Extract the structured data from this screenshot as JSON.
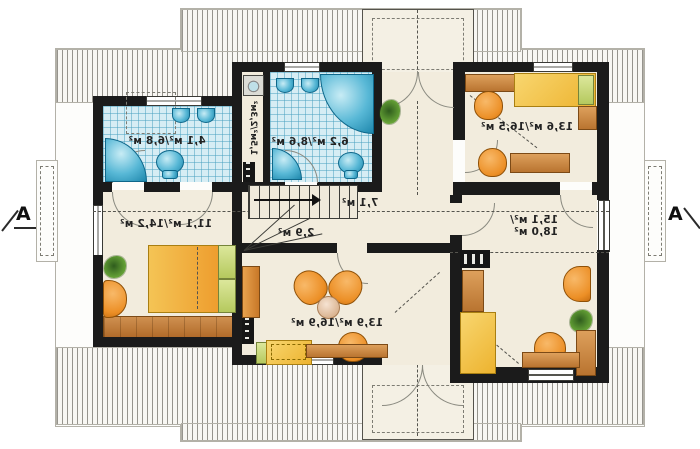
{
  "drawing": {
    "type": "attic floor plan",
    "section_markers": {
      "left": "A",
      "right": "A"
    },
    "rooms": {
      "bath_top_left": {
        "area": "4,1 м²/6,8 м²"
      },
      "dressing": {
        "area": "1,5м²/2,3м²"
      },
      "bath_main": {
        "area": "6,2 м²/8,6 м²"
      },
      "bedroom_top_right": {
        "area": "13,6 м²/16,5 м²"
      },
      "bedroom_left": {
        "area": "11,1 м²/14,2 м²"
      },
      "hall": {
        "area": "7,1 м²"
      },
      "staircase": {
        "area": "2,9 м²"
      },
      "bedroom_right": {
        "area_line1": "15,1 м²/",
        "area_line2": "18,0 м²"
      },
      "living_room": {
        "area": "13,9 м²/16,9 м²"
      }
    },
    "colors": {
      "wall": "#1b1b1b",
      "bath_tile": "#d6edf4",
      "fixture_blue": "#58b8d6",
      "furniture_orange": "#ec8f26",
      "furniture_yellow": "#edb32f",
      "wood": "#b97430",
      "floor": "#f2ecdd"
    }
  }
}
